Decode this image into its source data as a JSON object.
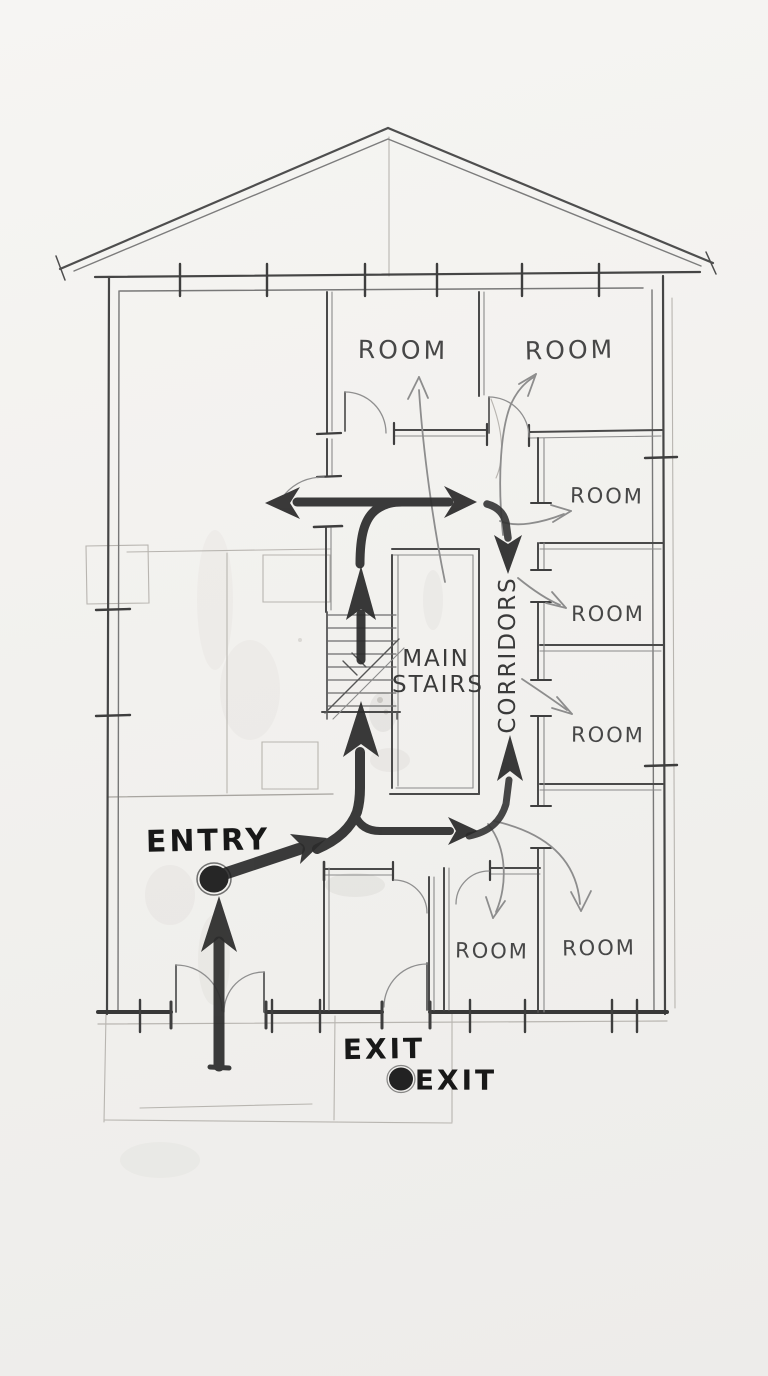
{
  "diagram": {
    "kind": "hand-drawn floor plan evacuation sketch",
    "labels": {
      "rooms": [
        {
          "id": "top-center",
          "text": "ROOM"
        },
        {
          "id": "top-right",
          "text": "ROOM"
        },
        {
          "id": "right-upper",
          "text": "ROOM"
        },
        {
          "id": "right-middle",
          "text": "ROOM"
        },
        {
          "id": "right-lower",
          "text": "ROOM"
        },
        {
          "id": "bottom-center",
          "text": "ROOM"
        },
        {
          "id": "bottom-right",
          "text": "ROOM"
        }
      ],
      "main_stairs_line1": "MAIN",
      "main_stairs_line2": "STAIRS",
      "corridors": "CORRIDORS",
      "entry": "ENTRY",
      "exit_door": "EXIT",
      "exit_marker": "EXIT"
    },
    "colors": {
      "paper": "#f3f2ef",
      "pencil_dark": "#2c2c2c",
      "pencil_mid": "#4a4a4a",
      "pencil_light": "#8d8d8d",
      "construction": "#b8b5b0"
    }
  }
}
